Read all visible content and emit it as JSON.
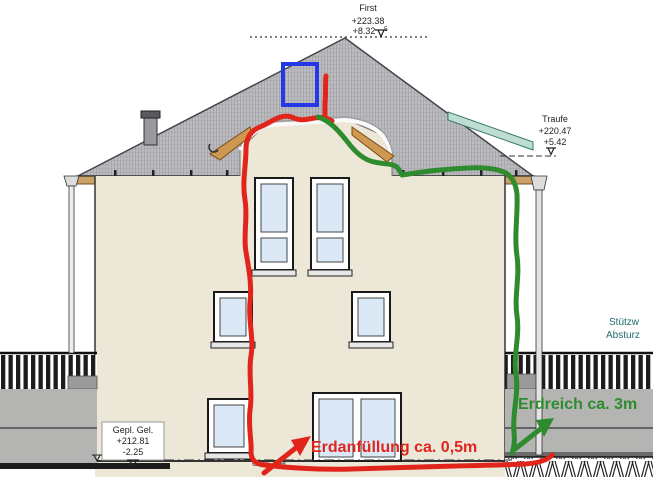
{
  "levels": {
    "first": {
      "label": "First",
      "elevation": "+223.38",
      "relative": "+8.32",
      "relative_sup": "5"
    },
    "traufe": {
      "label": "Traufe",
      "elevation": "+220.47",
      "relative": "+5.42"
    },
    "gepl_gel": {
      "label": "Gepl. Gel.",
      "elevation": "+212.81",
      "relative": "-2.25"
    },
    "gepl_gel_ground_label": "Gepl. Gel."
  },
  "side_labels": {
    "line1": "Stützw",
    "line2": "Absturz"
  },
  "annotations": {
    "fill_note": "Erdanfüllung ca. 0,5m",
    "earth_note": "Erdreich ca. 3m"
  },
  "colors": {
    "annotation_red": "#e1251b",
    "annotation_green": "#2e8b2e",
    "annotation_blue": "#2438e8",
    "teal_label": "#1f6f6f",
    "wall": "#ece7d7",
    "roof": "#bcbcc0",
    "glass": "#dbe9f6",
    "retaining_wall": "#b4b4b2",
    "fascia": "#caa166"
  }
}
